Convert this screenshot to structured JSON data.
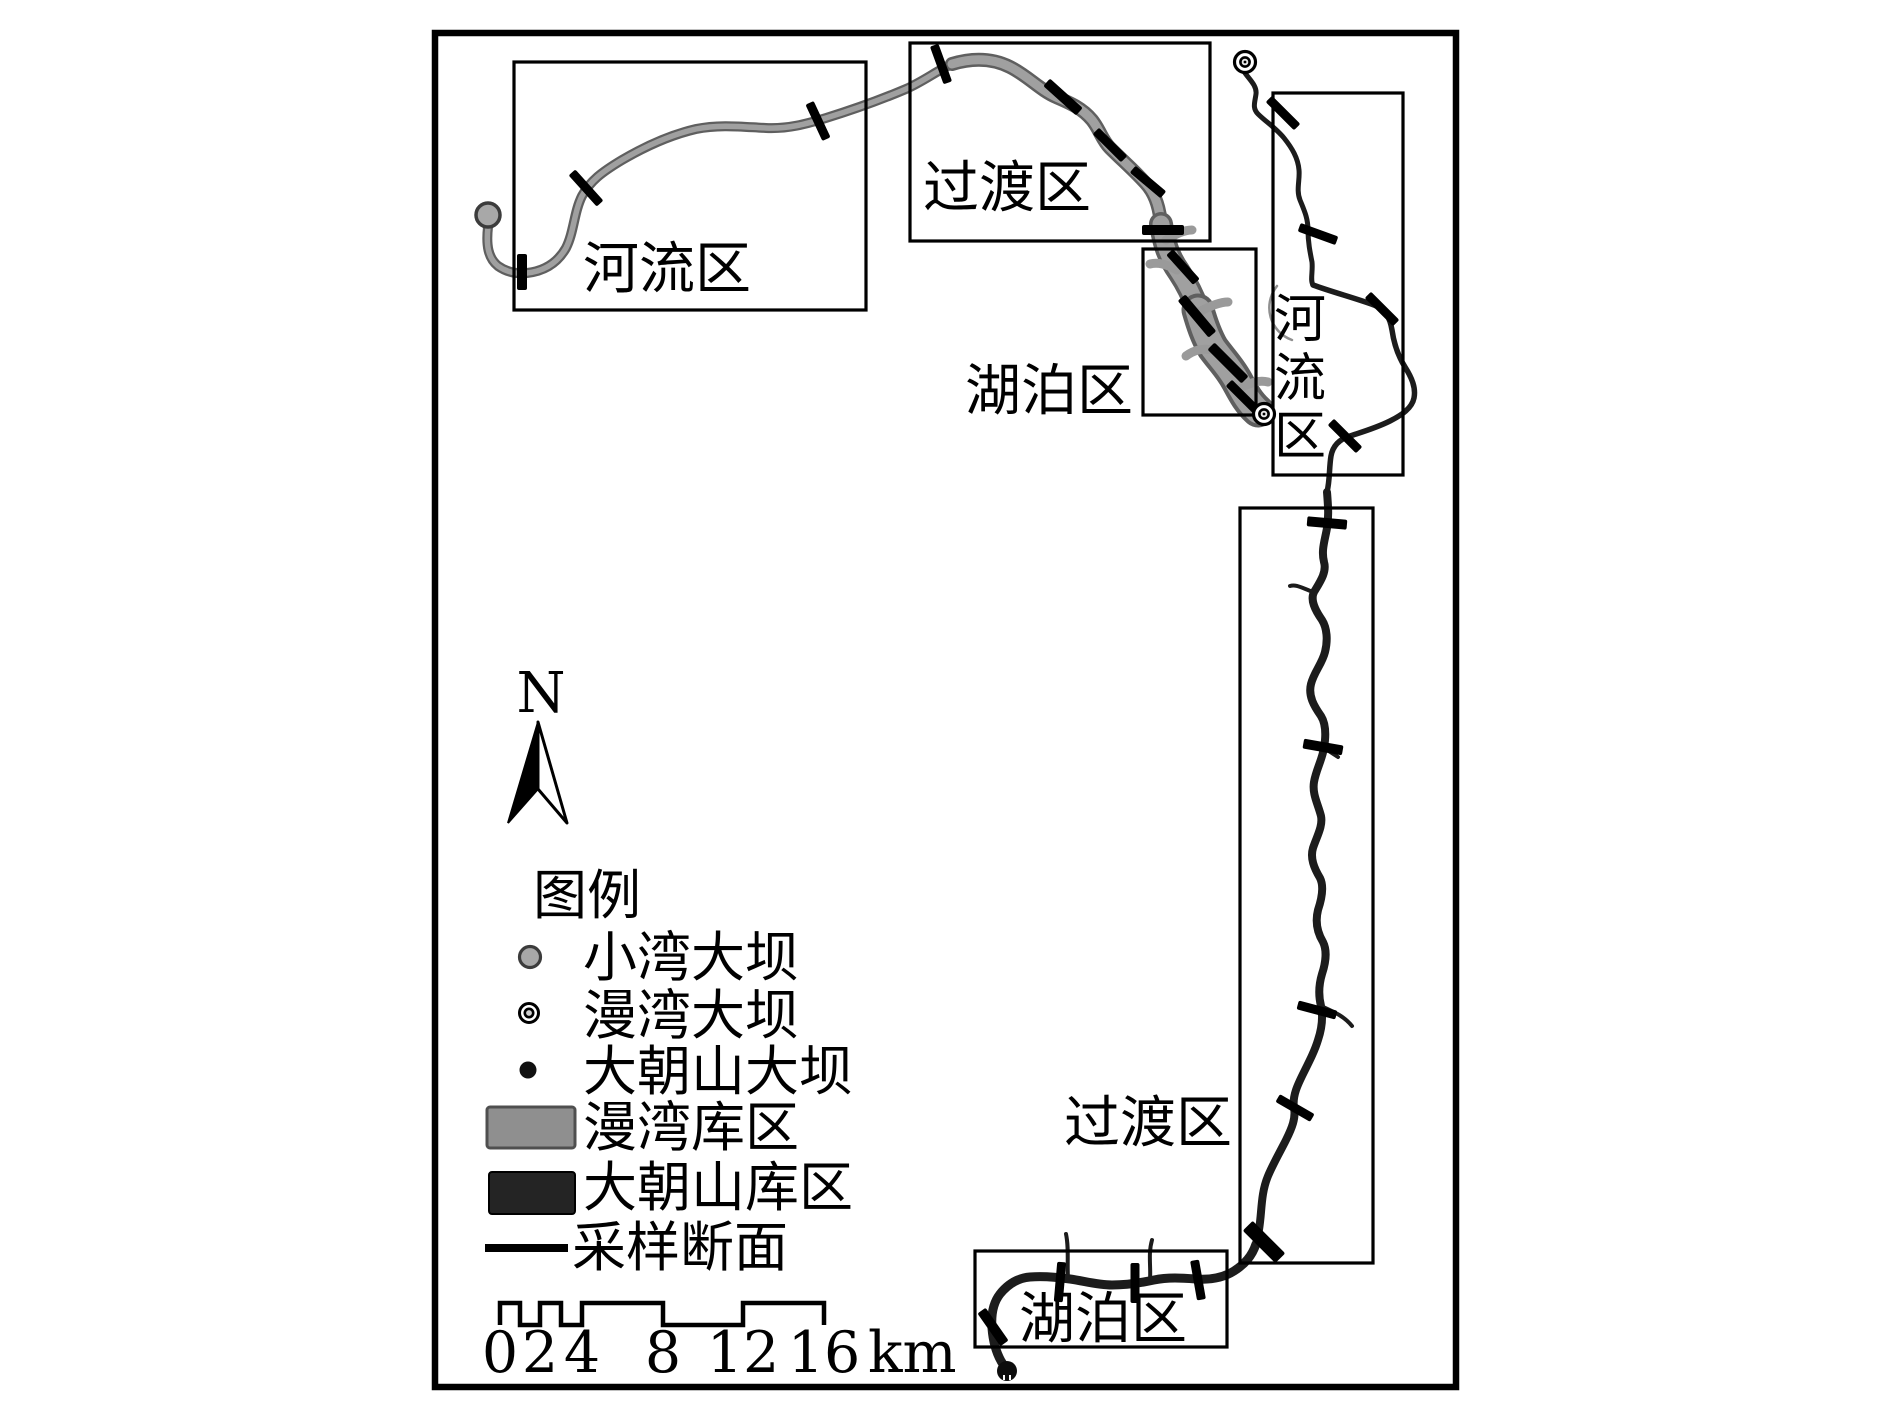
{
  "figure": {
    "type": "reservoir-zonation-map",
    "north_label": "N",
    "zones": {
      "river_west": "河流区",
      "transition_north": "过渡区",
      "lake_north": "湖泊区",
      "river_east": "河流区",
      "river_east_chars": [
        "河",
        "流",
        "区"
      ],
      "transition_east": "过渡区",
      "lake_south": "湖泊区"
    },
    "legend": {
      "title": "图例",
      "items": [
        {
          "symbol": "gray-circle",
          "label": "小湾大坝"
        },
        {
          "symbol": "double-circle",
          "label": "漫湾大坝"
        },
        {
          "symbol": "black-circle",
          "label": "大朝山大坝"
        },
        {
          "symbol": "gray-rect",
          "label": "漫湾库区"
        },
        {
          "symbol": "black-rect",
          "label": "大朝山库区"
        },
        {
          "symbol": "black-line",
          "label": "采样断面"
        }
      ]
    },
    "scale_bar": {
      "labels": [
        "0",
        "2",
        "4",
        "8",
        "12",
        "16"
      ],
      "unit": "km"
    },
    "colors": {
      "manwan_reservoir": "#a0a0a0",
      "manwan_reservoir_edge": "#5f5f5f",
      "dachaoshan_reservoir": "#1c1c1c",
      "xiaowan_dam_fill": "#a8a8a8",
      "map_outline": "#000000"
    },
    "dams": [
      {
        "name": "小湾大坝",
        "type": "gray-circle",
        "x": 488,
        "y": 215
      },
      {
        "name": "漫湾大坝",
        "type": "double-circle",
        "x": 1245,
        "y": 62
      },
      {
        "name": "漫湾大坝",
        "type": "double-circle",
        "x": 1264,
        "y": 414
      },
      {
        "name": "大朝山大坝",
        "type": "black-circle",
        "x": 1007,
        "y": 1371
      }
    ],
    "sampling_sections": [
      {
        "x": 522,
        "y": 272,
        "a": 90,
        "l": 36,
        "w": 10
      },
      {
        "x": 586,
        "y": 188,
        "a": 48,
        "l": 42,
        "w": 9
      },
      {
        "x": 818,
        "y": 121,
        "a": 65,
        "l": 40,
        "w": 9
      },
      {
        "x": 941,
        "y": 64,
        "a": 70,
        "l": 40,
        "w": 9
      },
      {
        "x": 1063,
        "y": 97,
        "a": 42,
        "l": 44,
        "w": 10
      },
      {
        "x": 1110,
        "y": 145,
        "a": 45,
        "l": 40,
        "w": 9
      },
      {
        "x": 1148,
        "y": 182,
        "a": 40,
        "l": 40,
        "w": 9
      },
      {
        "x": 1163,
        "y": 230,
        "a": 0,
        "l": 42,
        "w": 10
      },
      {
        "x": 1183,
        "y": 267,
        "a": 48,
        "l": 40,
        "w": 9
      },
      {
        "x": 1197,
        "y": 316,
        "a": 50,
        "l": 48,
        "w": 10
      },
      {
        "x": 1228,
        "y": 363,
        "a": 45,
        "l": 48,
        "w": 10
      },
      {
        "x": 1243,
        "y": 397,
        "a": 45,
        "l": 40,
        "w": 9
      },
      {
        "x": 1283,
        "y": 113,
        "a": 45,
        "l": 40,
        "w": 9
      },
      {
        "x": 1318,
        "y": 234,
        "a": 20,
        "l": 40,
        "w": 9
      },
      {
        "x": 1382,
        "y": 309,
        "a": 45,
        "l": 40,
        "w": 9
      },
      {
        "x": 1345,
        "y": 436,
        "a": 45,
        "l": 40,
        "w": 9
      },
      {
        "x": 1327,
        "y": 523,
        "a": 5,
        "l": 40,
        "w": 10
      },
      {
        "x": 1323,
        "y": 747,
        "a": 10,
        "l": 40,
        "w": 10
      },
      {
        "x": 1317,
        "y": 1010,
        "a": 15,
        "l": 40,
        "w": 9
      },
      {
        "x": 1295,
        "y": 1108,
        "a": 30,
        "l": 40,
        "w": 9
      },
      {
        "x": 1264,
        "y": 1242,
        "a": 45,
        "l": 46,
        "w": 14
      },
      {
        "x": 1060,
        "y": 1282,
        "a": 95,
        "l": 40,
        "w": 9
      },
      {
        "x": 1135,
        "y": 1283,
        "a": 90,
        "l": 40,
        "w": 9
      },
      {
        "x": 1198,
        "y": 1280,
        "a": 80,
        "l": 40,
        "w": 9
      },
      {
        "x": 993,
        "y": 1327,
        "a": 55,
        "l": 40,
        "w": 10
      }
    ]
  }
}
